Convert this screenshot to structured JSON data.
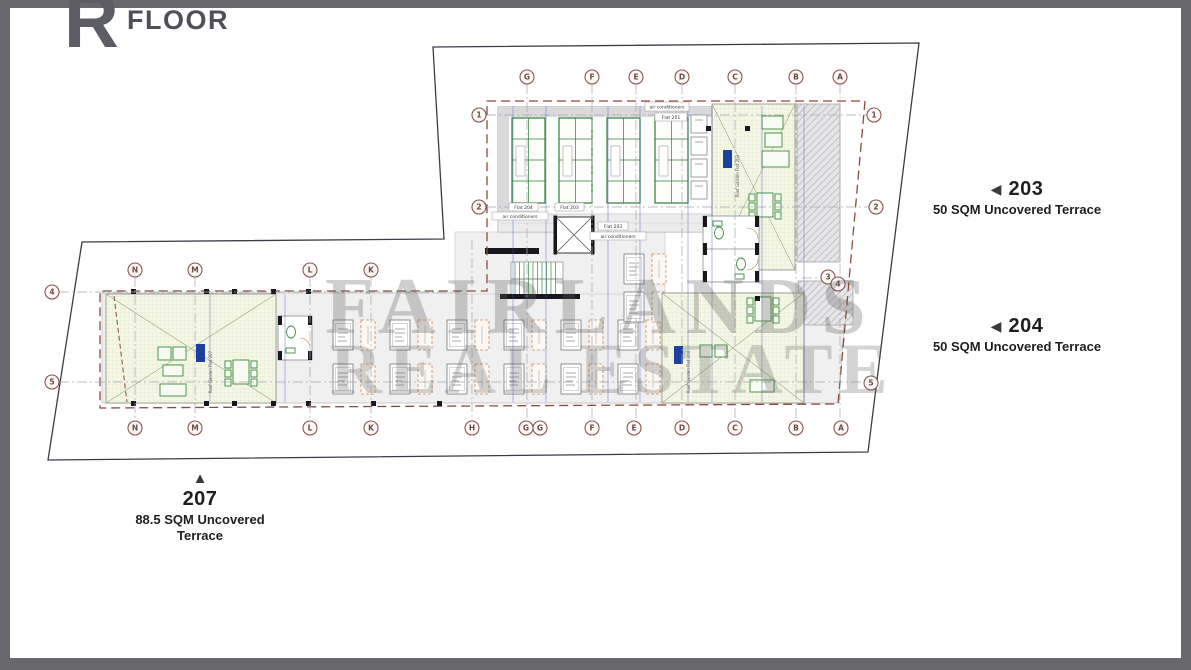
{
  "page": {
    "background": "#ffffff",
    "frame_color": "#68686c"
  },
  "logo": {
    "letter": "R",
    "word": "FLOOR"
  },
  "watermark": {
    "line1": "FAIRLANDS",
    "line2": "REAL ESTATE"
  },
  "unit_labels": [
    {
      "arrow_glyph": "◀",
      "number": "203",
      "desc": [
        "50 SQM Uncovered Terrace"
      ]
    },
    {
      "arrow_glyph": "◀",
      "number": "204",
      "desc": [
        "50 SQM Uncovered Terrace"
      ]
    },
    {
      "arrow_glyph": "▲",
      "number": "207",
      "desc": [
        "88.5 SQM Uncovered",
        "Terrace"
      ]
    }
  ],
  "plan": {
    "grid_bubbles": {
      "top": [
        "G",
        "F",
        "E",
        "D",
        "C",
        "B",
        "A"
      ],
      "bottom": [
        "H",
        "G",
        "G",
        "F",
        "E",
        "D",
        "C",
        "B",
        "A"
      ],
      "wing_top": [
        "N",
        "M",
        "L",
        "K"
      ],
      "wing_bottom": [
        "N",
        "M",
        "L",
        "K"
      ],
      "tower_left": [
        "1",
        "2"
      ],
      "wing_left": [
        "4",
        "5"
      ],
      "right": [
        "1",
        "2",
        "3",
        "4",
        "5"
      ]
    },
    "tiny_labels": {
      "air_conditioners": "air conditioners",
      "flat_201": "Flat 201",
      "flat_202": "Flat 202",
      "flat_203": "Flat 203",
      "flat_204": "Flat 204",
      "roof_garden_207": "Roof Garden Flat 207",
      "roof_garden_203": "Roof Garden Flat 203",
      "roof_garden_204": "Roof Garden Flat 204"
    },
    "colors": {
      "site_boundary": "#3c3c46",
      "setback_dashed": "#8a4a3e",
      "grid_centerline": "#a8a8ae",
      "bubble": "#8a5550",
      "panel_green": "#2f7d36",
      "furniture_green": "#3c8a42",
      "terrace_fill": "#f5f7e6",
      "dimension_blue": "#3a56c8",
      "equipment_tan": "#c8875a",
      "label_blue": "#1d3f9f"
    }
  }
}
